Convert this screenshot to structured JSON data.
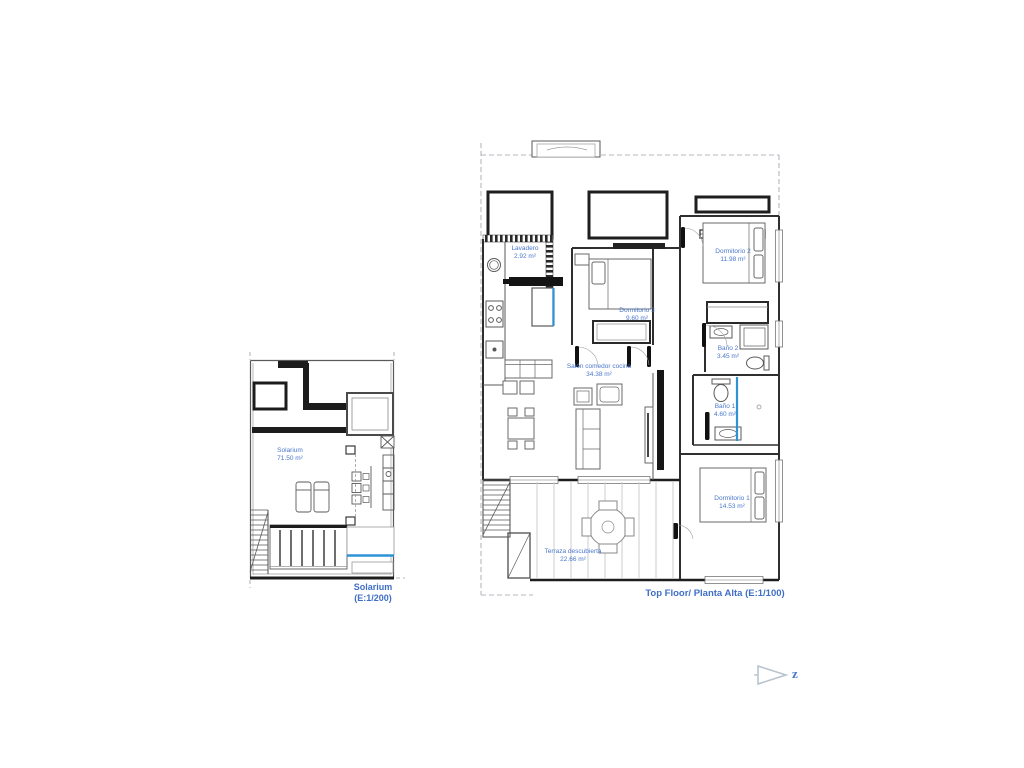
{
  "plans": [
    {
      "id": "solarium",
      "scale_label_lines": [
        "Solarium",
        "(E:1/200)"
      ],
      "rooms": [
        {
          "name": "Solarium",
          "area": "71.50 m²"
        }
      ]
    },
    {
      "id": "top-floor",
      "title": "Top Floor/ Planta Alta (E:1/100)",
      "rooms": [
        {
          "name": "Lavadero",
          "area": "2.92 m²"
        },
        {
          "name": "Dormitorio 3",
          "area": "9.60 m²"
        },
        {
          "name": "Dormitorio 2",
          "area": "11.98 m²"
        },
        {
          "name": "Baño 2",
          "area": "3.45 m²"
        },
        {
          "name": "Baño 1",
          "area": "4.60 m²"
        },
        {
          "name": "Dormitorio 1",
          "area": "14.53 m²"
        },
        {
          "name": "Salón comedor cocina",
          "area": "34.38 m²"
        },
        {
          "name": "Terraza descubierta",
          "area": "22.66 m²"
        }
      ]
    }
  ],
  "north_indicator": {
    "label": "z",
    "icon": "north-arrow"
  },
  "colors": {
    "label_blue": "#4a77cb",
    "title_blue": "#3f6ec6",
    "accent_blue": "#2e93d5",
    "wall_dark": "#2f2f2f",
    "line_gray": "#777777"
  }
}
